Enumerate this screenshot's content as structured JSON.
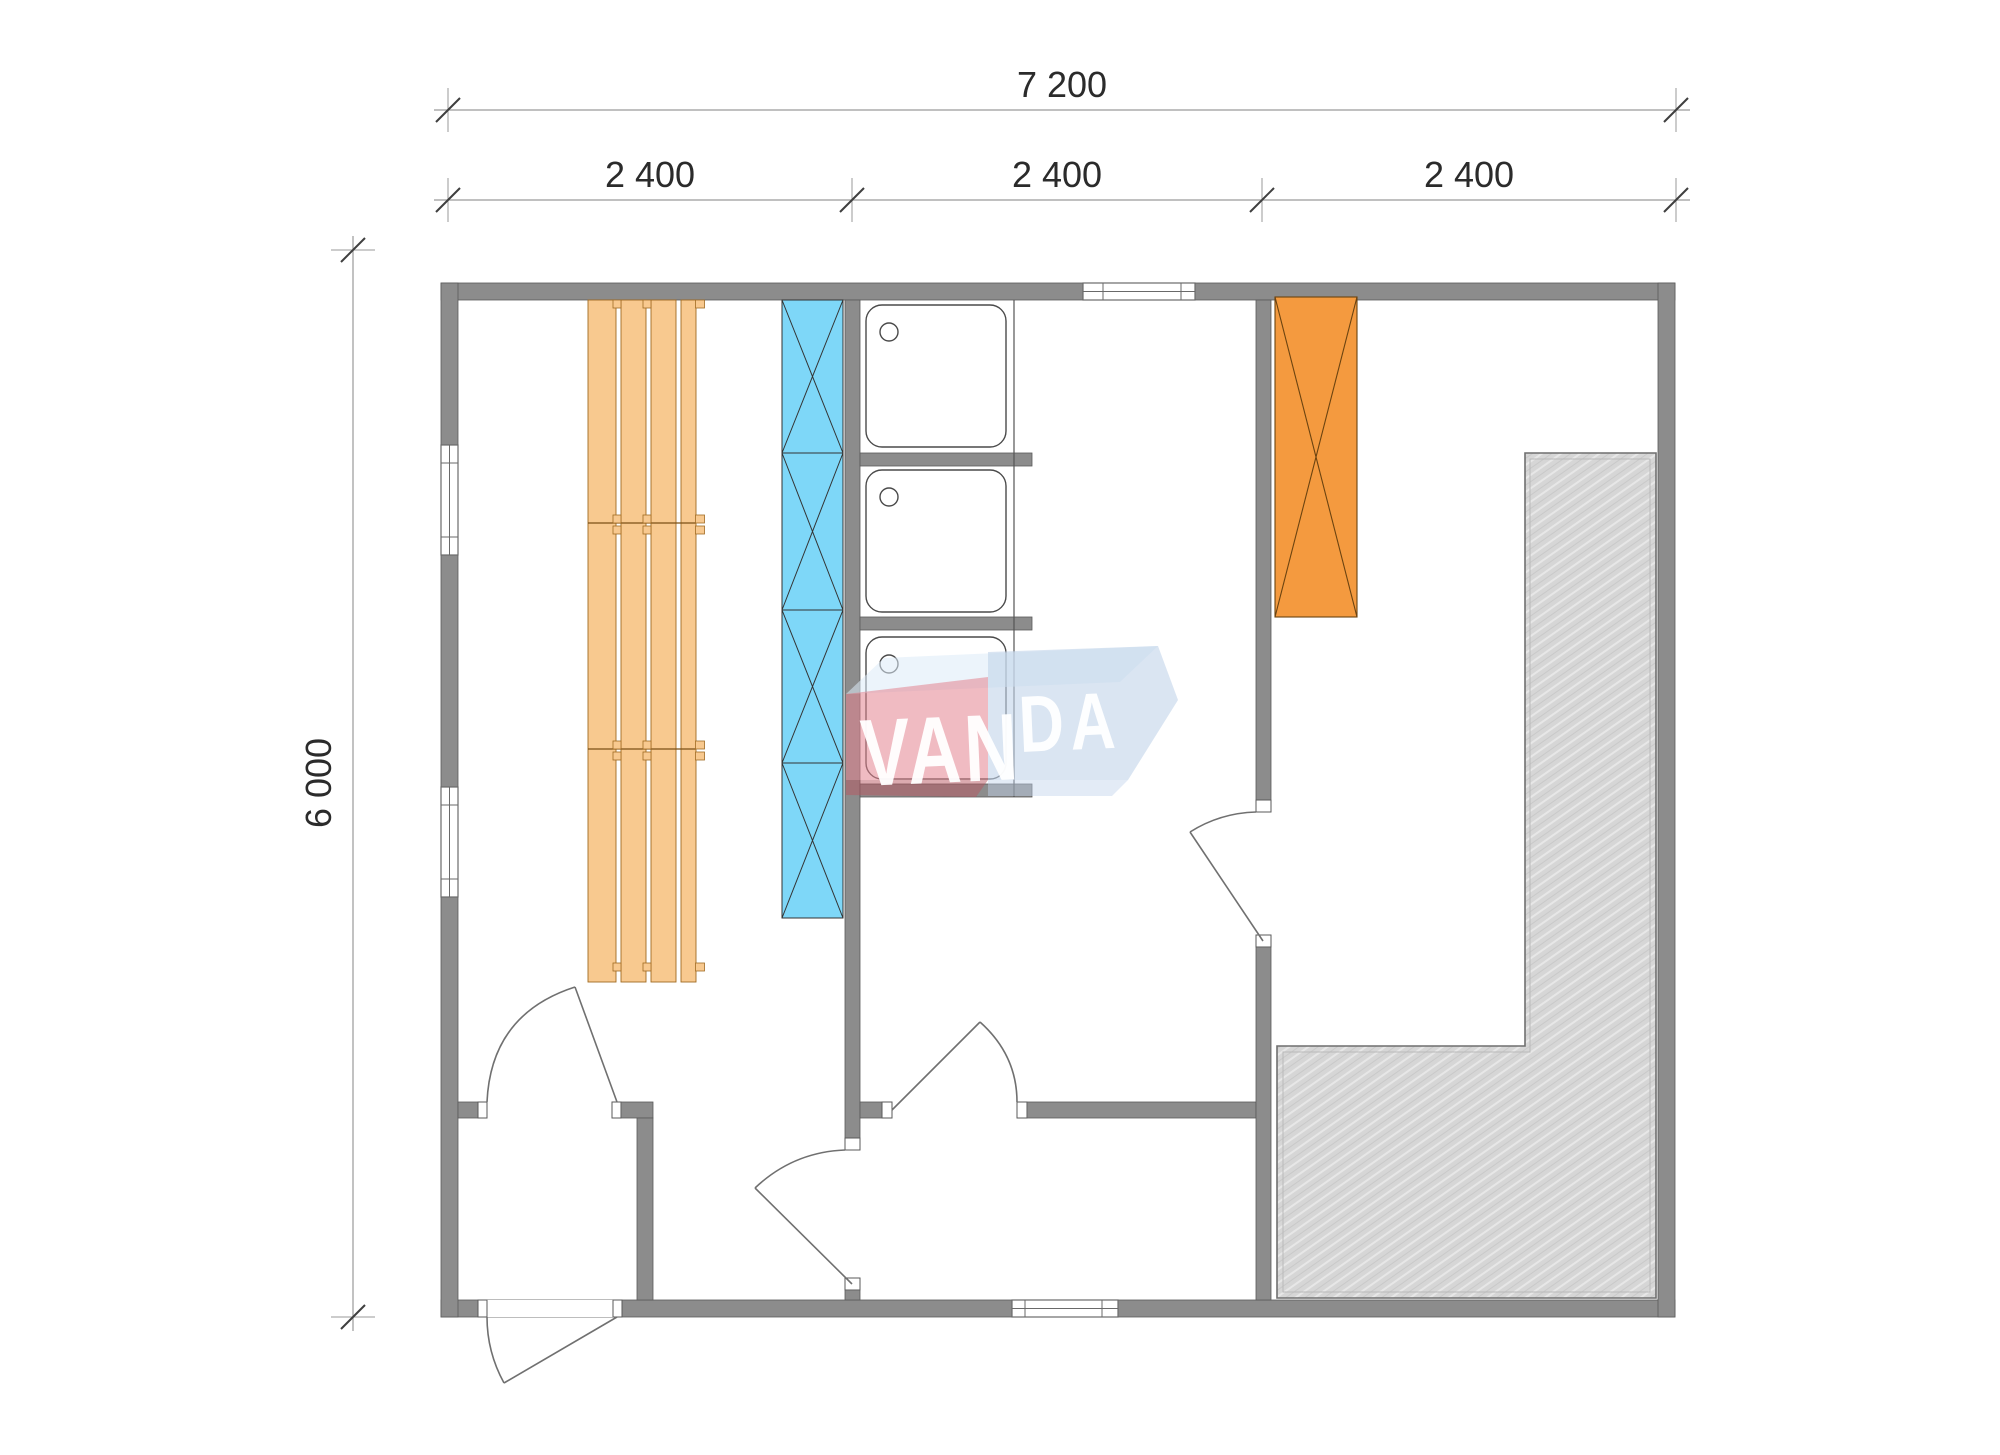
{
  "dimensions": {
    "top_total": {
      "label": "7 200"
    },
    "top_modules": [
      {
        "label": "2 400"
      },
      {
        "label": "2 400"
      },
      {
        "label": "2 400"
      }
    ],
    "left_height": {
      "label": "6 000"
    }
  },
  "watermark": {
    "brand": "VANDA",
    "left_text": "VAN",
    "right_text": "DA"
  },
  "colors": {
    "wall": "#8c8c8c",
    "wall_edge": "#5a5a5a",
    "bench": "#f8c98f",
    "bench_edge": "#a06b22",
    "heater": "#7ed7f8",
    "storage": "#f49a3f",
    "terrace": "#d6d6d6",
    "dim_text": "#2b2b2b",
    "watermark_red": "#e4848f",
    "watermark_red_dark": "#b85560",
    "watermark_blue": "#c2d3ea",
    "watermark_blue_light": "#dcebf8"
  }
}
